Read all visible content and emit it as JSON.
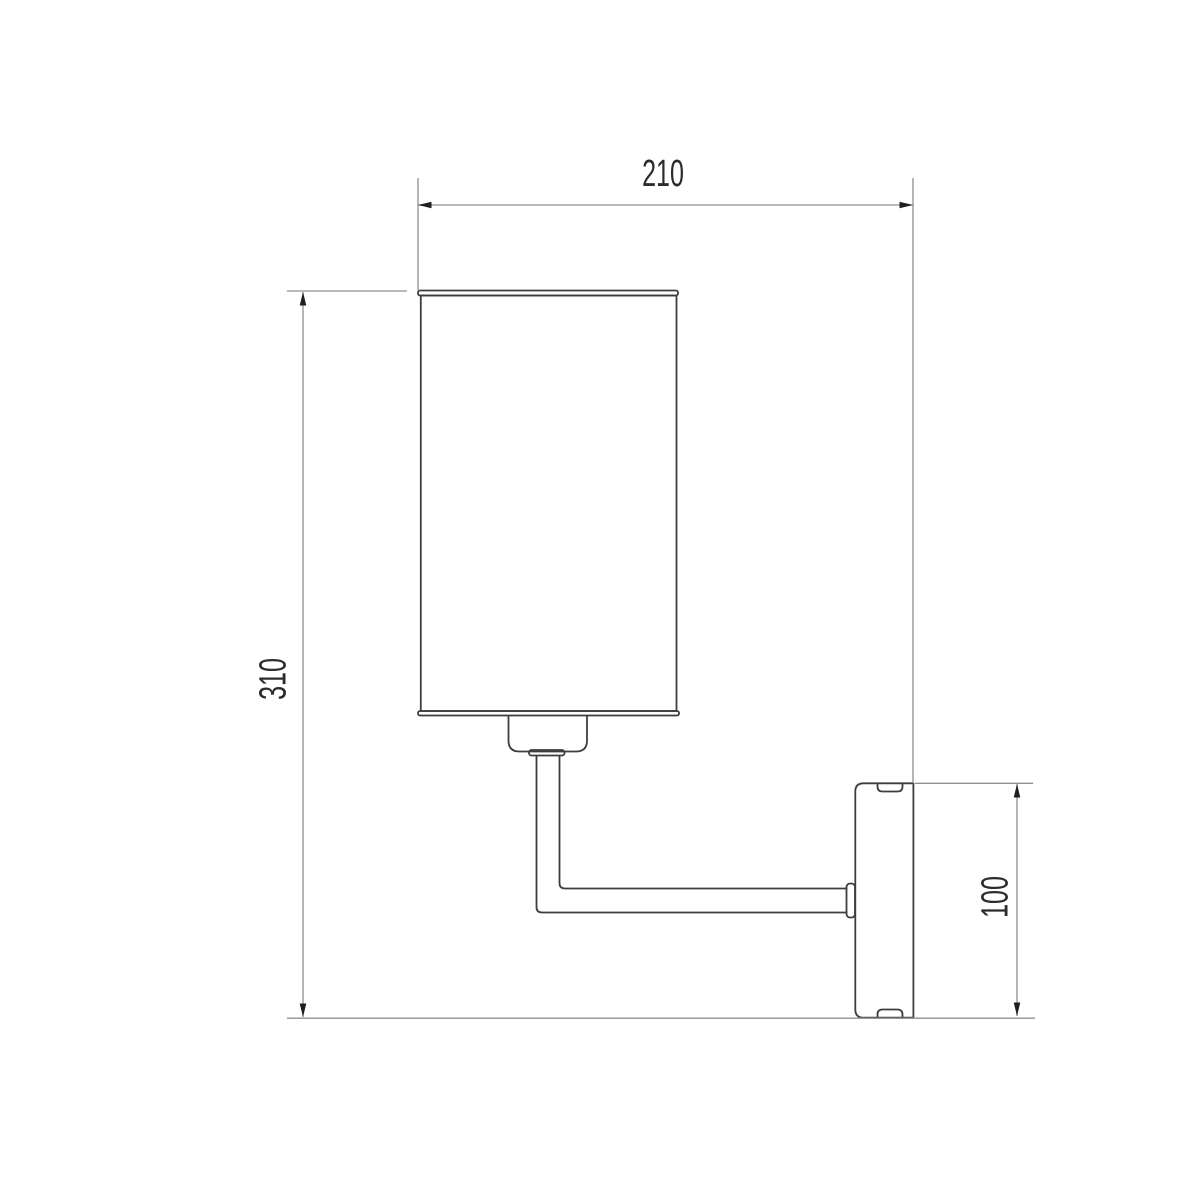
{
  "drawing": {
    "description": "Technical dimension drawing of a wall-mounted sconce lamp, side view: cylindrical shade on an L-shaped arm attached to a wall backplate",
    "labels": {
      "width": "210",
      "height": "310",
      "backplate": "100"
    },
    "colors": {
      "background": "#ffffff",
      "outline": "#3d3d3d",
      "dimension": "#8f8f8f",
      "arrow": "#1f1f1f",
      "text": "#2c2c2c"
    }
  }
}
